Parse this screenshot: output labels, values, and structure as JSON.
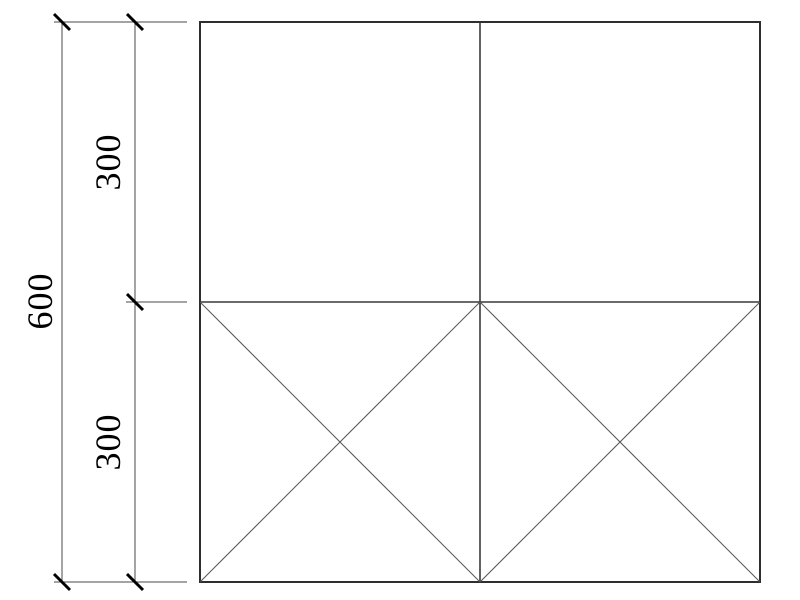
{
  "drawing": {
    "kind": "technical-drawing",
    "labels": {
      "overall": "600",
      "upper_segment": "300",
      "lower_segment": "300"
    },
    "colors": {
      "outline": "#2e2e2e",
      "divider": "#3a3a3a",
      "diagonal": "#555555",
      "dimension_line": "#4a4a4a",
      "tick": "#000000",
      "text": "#000000",
      "background": "#ffffff"
    }
  }
}
